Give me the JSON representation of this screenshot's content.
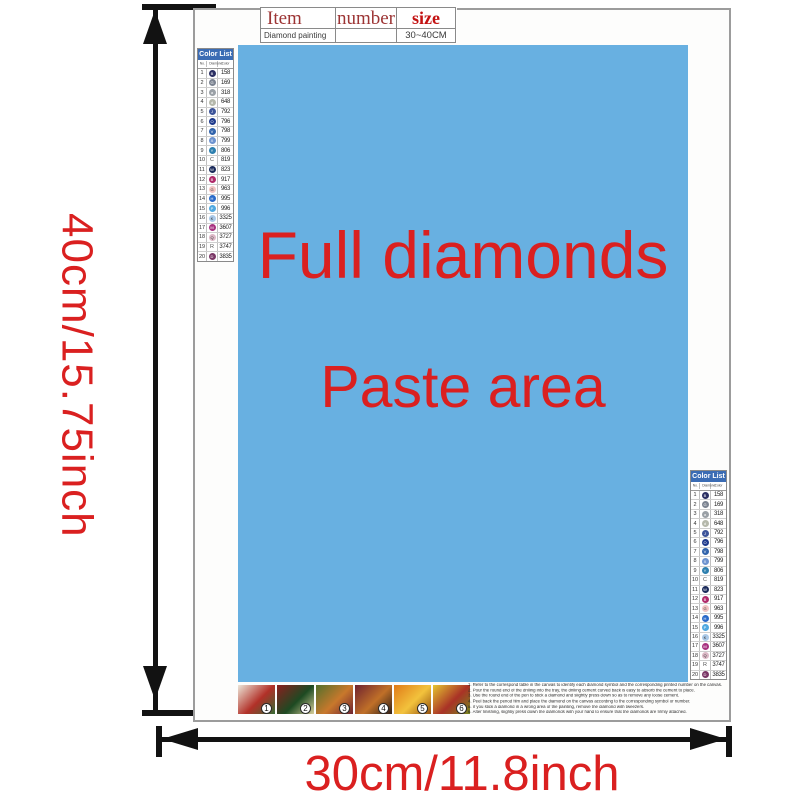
{
  "dimension_labels": {
    "height": "40cm/15.75inch",
    "width": "30cm/11.8inch",
    "color": "#da2020"
  },
  "item_table": {
    "col_item": "Item",
    "col_number": "number",
    "col_size": "size",
    "row_item": "Diamond painting",
    "row_number": "",
    "row_size": "30~40CM"
  },
  "paste_area": {
    "line1": "Full diamonds",
    "line2": "Paste area",
    "bg_color": "#68b0e1",
    "text_color": "#da2020"
  },
  "color_list": {
    "title": "Color List",
    "col_no": "No.",
    "col_symbol": "Diamond",
    "col_color": "Color",
    "header_bg": "#3b6cb4",
    "rows": [
      {
        "no": "1",
        "sym": "B",
        "code": "158",
        "color": "#2b2f63",
        "style": "circle"
      },
      {
        "no": "2",
        "sym": "G",
        "code": "169",
        "color": "#7b8391",
        "style": "circle"
      },
      {
        "no": "3",
        "sym": "a",
        "code": "318",
        "color": "#9aa0a6",
        "style": "circle"
      },
      {
        "no": "4",
        "sym": "d",
        "code": "648",
        "color": "#b5b8ab",
        "style": "circle"
      },
      {
        "no": "5",
        "sym": "J",
        "code": "792",
        "color": "#3d5499",
        "style": "circle"
      },
      {
        "no": "6",
        "sym": "O",
        "code": "796",
        "color": "#1e3a8c",
        "style": "circle"
      },
      {
        "no": "7",
        "sym": "V",
        "code": "798",
        "color": "#3163ab",
        "style": "circle"
      },
      {
        "no": "8",
        "sym": "X",
        "code": "799",
        "color": "#6e93cf",
        "style": "circle"
      },
      {
        "no": "9",
        "sym": "Y",
        "code": "806",
        "color": "#2d7fae",
        "style": "circle"
      },
      {
        "no": "10",
        "sym": "C",
        "code": "819",
        "color": "#555555",
        "style": "letter"
      },
      {
        "no": "11",
        "sym": "W",
        "code": "823",
        "color": "#1a2a5a",
        "style": "circle"
      },
      {
        "no": "12",
        "sym": "B",
        "code": "917",
        "color": "#b02a6a",
        "style": "circle"
      },
      {
        "no": "13",
        "sym": "G",
        "code": "963",
        "color": "#f2c4c2",
        "style": "letter-circle"
      },
      {
        "no": "14",
        "sym": "H",
        "code": "995",
        "color": "#2a6ac9",
        "style": "circle"
      },
      {
        "no": "15",
        "sym": "P",
        "code": "996",
        "color": "#4fa8e0",
        "style": "circle"
      },
      {
        "no": "16",
        "sym": "K",
        "code": "3325",
        "color": "#aac9e8",
        "style": "letter-circle"
      },
      {
        "no": "17",
        "sym": "M",
        "code": "3607",
        "color": "#a83280",
        "style": "circle"
      },
      {
        "no": "18",
        "sym": "Q",
        "code": "3727",
        "color": "#dcb8c6",
        "style": "letter-circle"
      },
      {
        "no": "19",
        "sym": "R",
        "code": "3747",
        "color": "#555555",
        "style": "letter"
      },
      {
        "no": "20",
        "sym": "D",
        "code": "3835",
        "color": "#7a3766",
        "style": "circle"
      }
    ]
  },
  "steps": [
    {
      "num": "1",
      "colors": [
        "#ece6d8",
        "#b23028",
        "#356b33"
      ]
    },
    {
      "num": "2",
      "colors": [
        "#8a1f1f",
        "#1d4a22",
        "#d8cf9a"
      ]
    },
    {
      "num": "3",
      "colors": [
        "#53702c",
        "#c8782c",
        "#6e2230"
      ]
    },
    {
      "num": "4",
      "colors": [
        "#6e2230",
        "#c07028",
        "#2e1e16"
      ]
    },
    {
      "num": "5",
      "colors": [
        "#e07a18",
        "#f2c23c",
        "#93500f"
      ]
    },
    {
      "num": "6",
      "colors": [
        "#e5c531",
        "#a93226",
        "#75871f"
      ]
    }
  ],
  "instructions": {
    "lines": [
      "1. Refer to the correspond table in the canvas to identify each diamond symbol and the corresponding printed number on the canvas.",
      "2. Pour the round end of the drilling into the tray, the drilling cement curved back is easy to absorb the cement to place.",
      "3. Use the round end of the pen to stick a diamond and slightly press down so as to remove any loose cement.",
      "4. Peel back the period film and place the diamond on the canvas according to the corresponding symbol or number.",
      "5. If you stick a diamond in a wrong area of the painting, remove the diamond with tweezers.",
      "6. After finishing, slightly press down the diamonds with your hand to ensure that the diamonds are firmly attached."
    ]
  }
}
